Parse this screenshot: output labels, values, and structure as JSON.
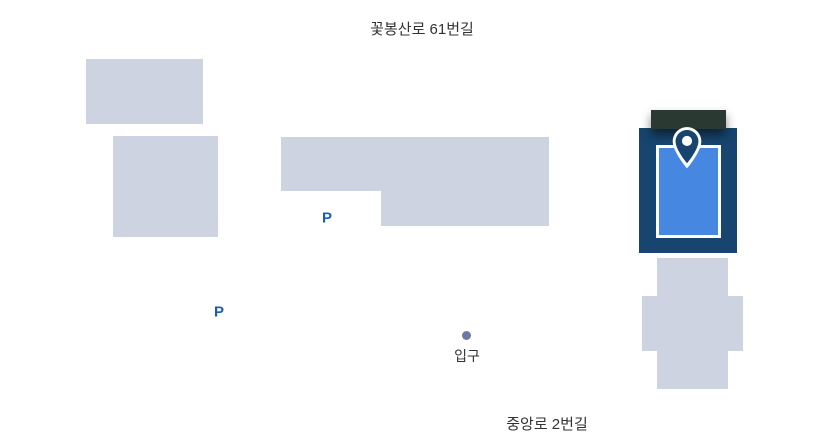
{
  "map": {
    "streets": {
      "top": "꽃봉산로 61번길",
      "bottom": "중앙로 2번길"
    },
    "markers": {
      "parking1": "P",
      "parking2": "P",
      "entrance_label": "입구",
      "entrance_dot_icon": "entrance-dot",
      "target_icon": "location-pin"
    },
    "colors": {
      "background": "#ffffff",
      "building_fill": "#cdd3e1",
      "target_frame": "#17456f",
      "target_fill": "#4687e2",
      "target_inner_border": "#ffffff",
      "roof": "#2a3a32",
      "parking_text": "#1a5cb8",
      "entrance_dot": "#6b7aa0",
      "street_text": "#333333"
    }
  }
}
